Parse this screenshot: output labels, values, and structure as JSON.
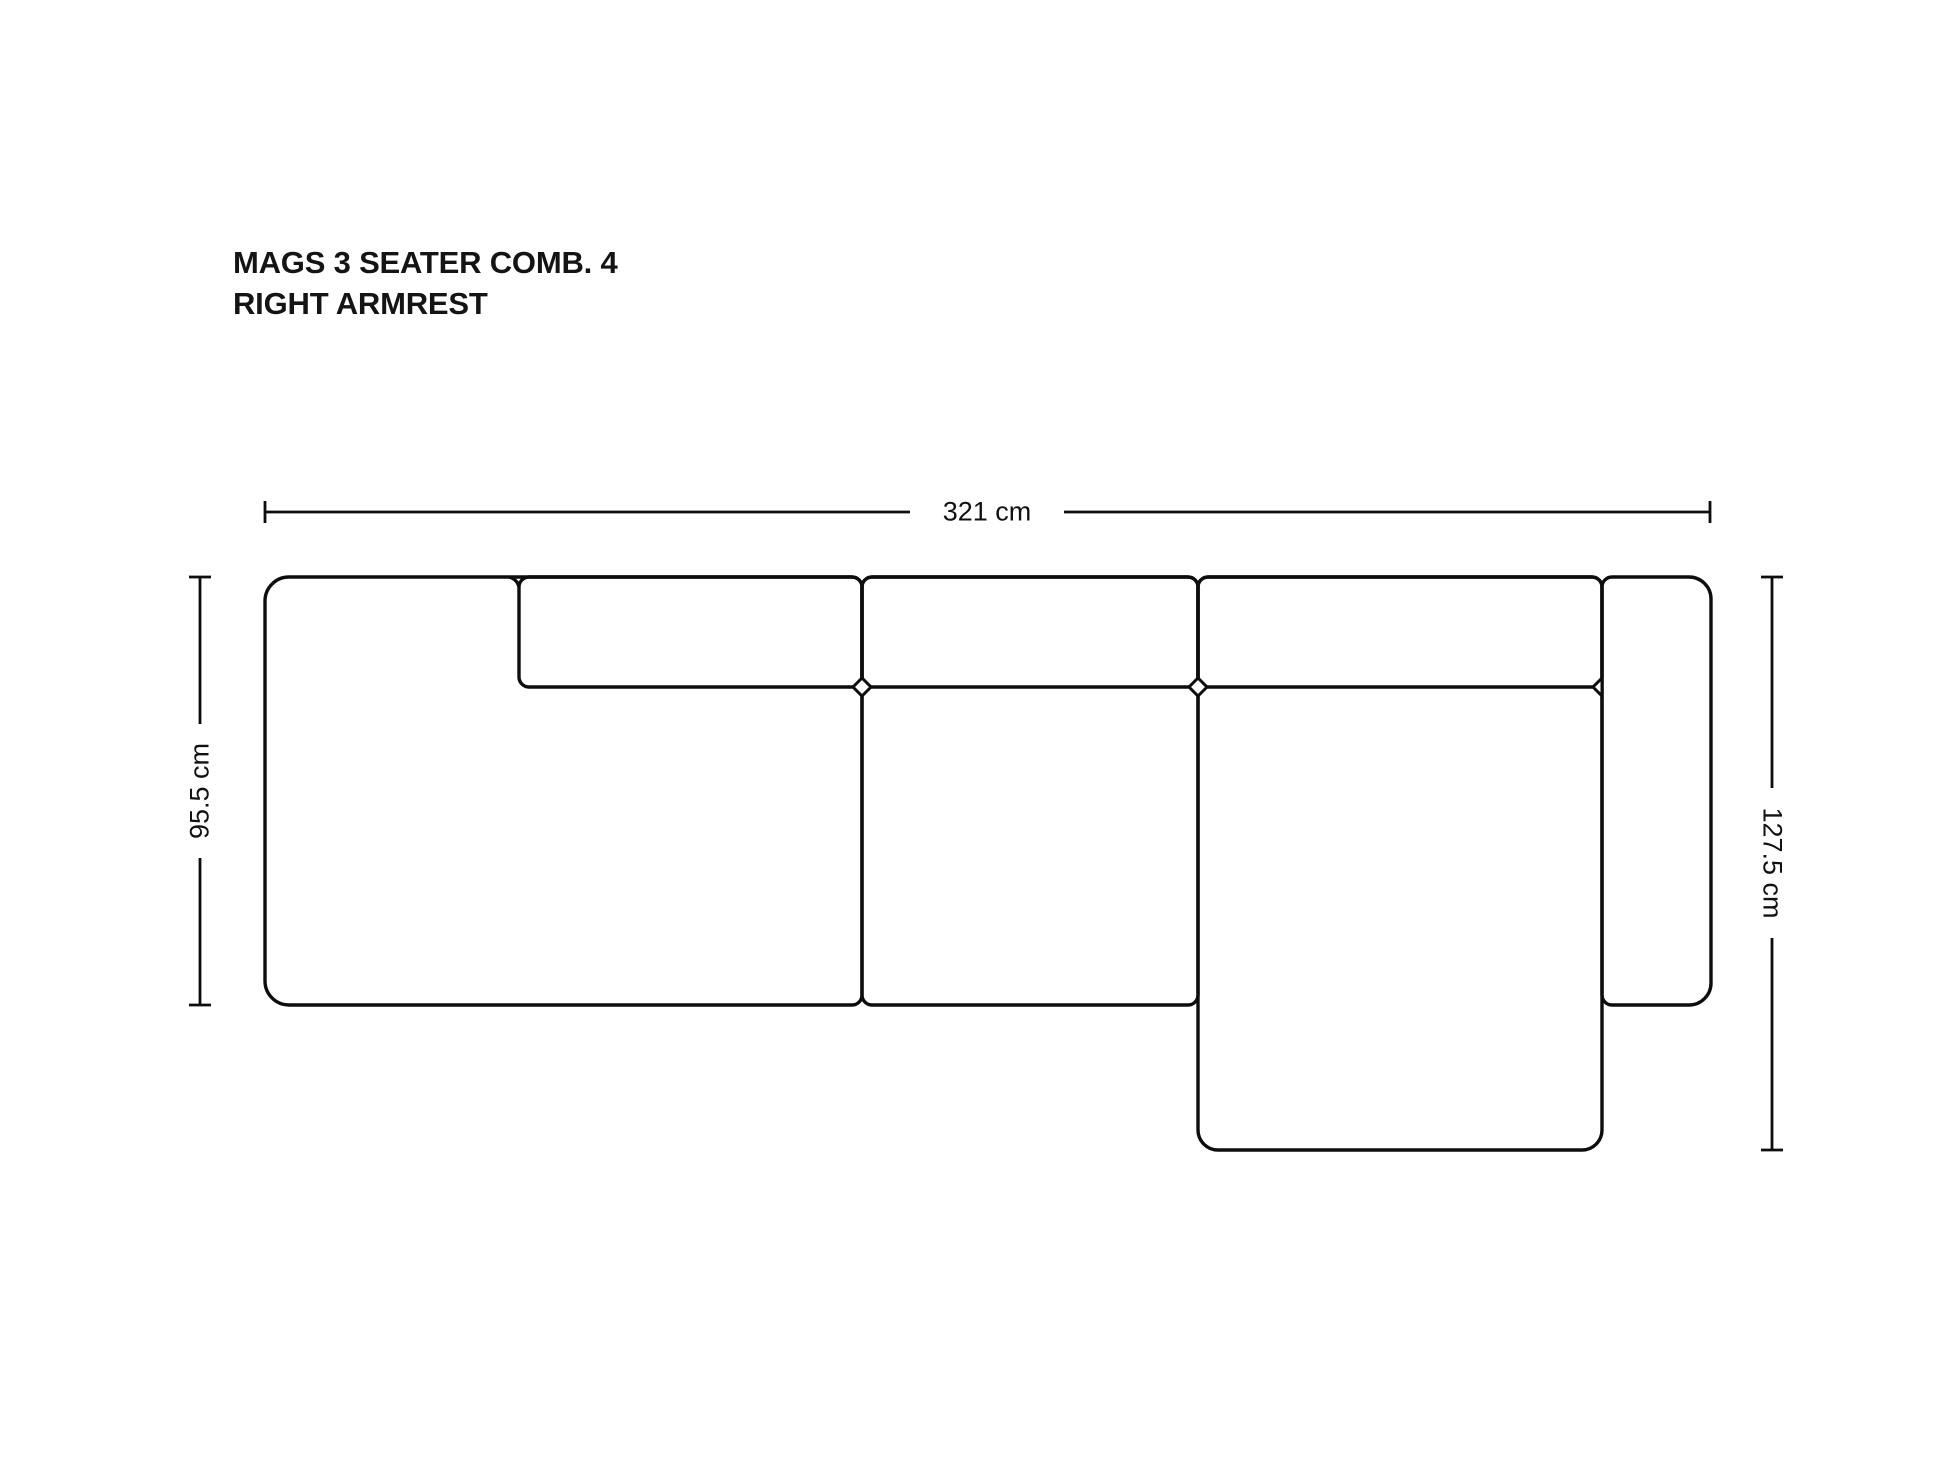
{
  "title": {
    "line1": "MAGS 3 SEATER COMB. 4",
    "line2": "RIGHT ARMREST"
  },
  "dimensions": {
    "width": {
      "label": "321 cm"
    },
    "depth_left": {
      "label": "95.5 cm"
    },
    "depth_right": {
      "label": "127.5 cm"
    }
  },
  "diagram": {
    "line_color": "#0d0d0d",
    "module_stroke_width": 3.4,
    "dim_stroke_width": 2.8,
    "modules": [
      {
        "name": "module-left",
        "x": 265,
        "y": 577,
        "w": 597,
        "h": 428,
        "radii": [
          24,
          10,
          10,
          24
        ]
      },
      {
        "name": "cushion-left-back",
        "x": 519,
        "y": 577,
        "w": 343,
        "h": 110,
        "radii": [
          10,
          10,
          10,
          10
        ]
      },
      {
        "name": "module-middle",
        "x": 862,
        "y": 577,
        "w": 336,
        "h": 428,
        "radii": [
          10,
          10,
          10,
          10
        ]
      },
      {
        "name": "cushion-middle-back",
        "x": 862,
        "y": 577,
        "w": 336,
        "h": 110,
        "radii": [
          10,
          10,
          10,
          10
        ]
      },
      {
        "name": "module-chaise",
        "x": 1198,
        "y": 577,
        "w": 404,
        "h": 573,
        "radii": [
          10,
          10,
          20,
          20
        ]
      },
      {
        "name": "cushion-chaise-back",
        "x": 1198,
        "y": 577,
        "w": 404,
        "h": 110,
        "radii": [
          10,
          10,
          10,
          10
        ]
      },
      {
        "name": "module-right-armrest",
        "x": 1602,
        "y": 577,
        "w": 109,
        "h": 428,
        "radii": [
          10,
          22,
          22,
          10
        ]
      }
    ],
    "joint_diamonds": [
      {
        "cx": 862,
        "cy": 687,
        "r": 9
      },
      {
        "cx": 1198,
        "cy": 687,
        "r": 9
      }
    ],
    "joint_half_diamonds": [
      {
        "cx": 1602,
        "cy": 687,
        "r": 9,
        "dir": "left"
      }
    ],
    "seam_notches": [
      {
        "x": 519,
        "y": 577,
        "r": 10,
        "side": "left"
      }
    ],
    "dim_segments": [
      {
        "x1": 265,
        "y1": 512,
        "x2": 910,
        "y2": 512
      },
      {
        "x1": 1064,
        "y1": 512,
        "x2": 1710,
        "y2": 512
      },
      {
        "x1": 265,
        "y1": 501,
        "x2": 265,
        "y2": 523
      },
      {
        "x1": 1710,
        "y1": 501,
        "x2": 1710,
        "y2": 523
      },
      {
        "x1": 200,
        "y1": 577,
        "x2": 200,
        "y2": 724
      },
      {
        "x1": 200,
        "y1": 858,
        "x2": 200,
        "y2": 1005
      },
      {
        "x1": 189,
        "y1": 577,
        "x2": 211,
        "y2": 577
      },
      {
        "x1": 189,
        "y1": 1005,
        "x2": 211,
        "y2": 1005
      },
      {
        "x1": 1772,
        "y1": 577,
        "x2": 1772,
        "y2": 788
      },
      {
        "x1": 1772,
        "y1": 938,
        "x2": 1772,
        "y2": 1150
      },
      {
        "x1": 1761,
        "y1": 577,
        "x2": 1783,
        "y2": 577
      },
      {
        "x1": 1761,
        "y1": 1150,
        "x2": 1783,
        "y2": 1150
      }
    ]
  }
}
